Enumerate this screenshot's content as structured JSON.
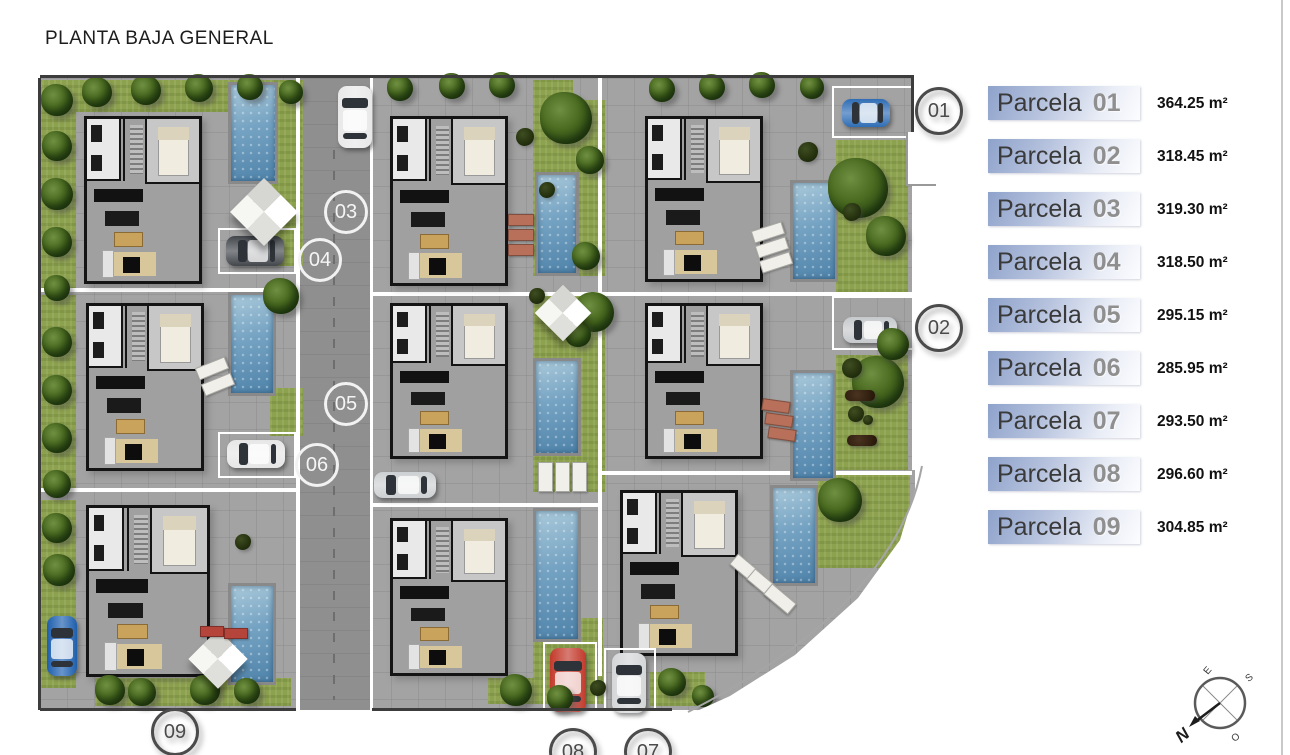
{
  "title": "PLANTA BAJA GENERAL",
  "legend": {
    "items": [
      {
        "label": "Parcela",
        "num": "01",
        "area": "364.25 m²"
      },
      {
        "label": "Parcela",
        "num": "02",
        "area": "318.45 m²"
      },
      {
        "label": "Parcela",
        "num": "03",
        "area": "319.30 m²"
      },
      {
        "label": "Parcela",
        "num": "04",
        "area": "318.50 m²"
      },
      {
        "label": "Parcela",
        "num": "05",
        "area": "295.15 m²"
      },
      {
        "label": "Parcela",
        "num": "06",
        "area": "285.95 m²"
      },
      {
        "label": "Parcela",
        "num": "07",
        "area": "293.50 m²"
      },
      {
        "label": "Parcela",
        "num": "08",
        "area": "296.60 m²"
      },
      {
        "label": "Parcela",
        "num": "09",
        "area": "304.85 m²"
      }
    ],
    "bar_x": 988,
    "bar_y_start": 86,
    "bar_step": 53,
    "area_x": 1157
  },
  "compass": {
    "n": "N",
    "e": "E",
    "s": "S",
    "o": "O"
  },
  "colors": {
    "pavement": "#a3a3a3",
    "road": "#8f8f8f",
    "lawn": "#8da24e",
    "pool_light": "#a9c9da",
    "pool_dark": "#4f83aa",
    "legend_blue": "#8ea2cb",
    "wall": "#141414"
  },
  "plan": {
    "base": [
      40,
      78,
      875,
      632
    ],
    "road": [
      300,
      78,
      72,
      632
    ],
    "road_dash": [
      333,
      150,
      550
    ],
    "lawns": [
      [
        40,
        80,
        36,
        210
      ],
      [
        42,
        80,
        258,
        32
      ],
      [
        272,
        80,
        31,
        186
      ],
      [
        533,
        80,
        40,
        34
      ],
      [
        533,
        100,
        72,
        176
      ],
      [
        836,
        140,
        72,
        152
      ],
      [
        40,
        295,
        36,
        194
      ],
      [
        270,
        388,
        33,
        48
      ],
      [
        533,
        292,
        72,
        200
      ],
      [
        836,
        355,
        72,
        115
      ],
      [
        40,
        500,
        36,
        188
      ],
      [
        95,
        678,
        196,
        28
      ],
      [
        533,
        618,
        70,
        86
      ],
      [
        488,
        678,
        46,
        26
      ],
      [
        818,
        473,
        92,
        95
      ],
      [
        650,
        672,
        55,
        34
      ]
    ],
    "pools": [
      [
        228,
        82,
        44,
        96
      ],
      [
        535,
        172,
        38,
        98
      ],
      [
        790,
        180,
        42,
        96
      ],
      [
        228,
        292,
        42,
        98
      ],
      [
        533,
        358,
        42,
        92
      ],
      [
        790,
        370,
        40,
        105
      ],
      [
        228,
        583,
        42,
        96
      ],
      [
        533,
        508,
        42,
        128
      ],
      [
        770,
        485,
        42,
        95
      ]
    ],
    "houses": [
      [
        84,
        116,
        112,
        162
      ],
      [
        390,
        116,
        112,
        164
      ],
      [
        645,
        116,
        112,
        160
      ],
      [
        86,
        303,
        112,
        162
      ],
      [
        390,
        303,
        112,
        150
      ],
      [
        645,
        303,
        112,
        150
      ],
      [
        86,
        505,
        118,
        166
      ],
      [
        390,
        518,
        112,
        152
      ],
      [
        620,
        490,
        112,
        160
      ]
    ],
    "trees": [
      [
        57,
        100,
        16
      ],
      [
        57,
        146,
        15
      ],
      [
        57,
        194,
        16
      ],
      [
        57,
        242,
        15
      ],
      [
        57,
        288,
        13
      ],
      [
        97,
        92,
        15
      ],
      [
        146,
        90,
        15
      ],
      [
        199,
        88,
        14
      ],
      [
        250,
        87,
        13
      ],
      [
        291,
        92,
        12
      ],
      [
        400,
        88,
        13
      ],
      [
        452,
        86,
        13
      ],
      [
        502,
        85,
        13
      ],
      [
        566,
        118,
        26
      ],
      [
        590,
        160,
        14
      ],
      [
        586,
        256,
        14
      ],
      [
        662,
        89,
        13
      ],
      [
        712,
        87,
        13
      ],
      [
        762,
        85,
        13
      ],
      [
        812,
        87,
        12
      ],
      [
        858,
        188,
        30
      ],
      [
        886,
        236,
        20
      ],
      [
        57,
        342,
        15
      ],
      [
        57,
        390,
        15
      ],
      [
        57,
        438,
        15
      ],
      [
        57,
        484,
        14
      ],
      [
        281,
        296,
        18
      ],
      [
        594,
        312,
        20
      ],
      [
        578,
        334,
        13
      ],
      [
        878,
        382,
        26
      ],
      [
        893,
        344,
        16
      ],
      [
        57,
        528,
        15
      ],
      [
        59,
        570,
        16
      ],
      [
        110,
        690,
        15
      ],
      [
        142,
        692,
        14
      ],
      [
        205,
        690,
        15
      ],
      [
        247,
        691,
        13
      ],
      [
        516,
        690,
        16
      ],
      [
        560,
        698,
        13
      ],
      [
        840,
        500,
        22
      ],
      [
        672,
        682,
        14
      ],
      [
        703,
        696,
        11
      ]
    ],
    "shrubs": [
      [
        525,
        137,
        9
      ],
      [
        547,
        190,
        8
      ],
      [
        537,
        296,
        8
      ],
      [
        808,
        152,
        10
      ],
      [
        852,
        212,
        9
      ],
      [
        852,
        368,
        10
      ],
      [
        243,
        542,
        8
      ],
      [
        598,
        688,
        8
      ],
      [
        856,
        414,
        8
      ],
      [
        868,
        420,
        5
      ]
    ],
    "umbrellas": [
      [
        240,
        188,
        48
      ],
      [
        543,
        293,
        40
      ],
      [
        197,
        638,
        42
      ]
    ],
    "lounger_groups": [
      {
        "x": 508,
        "y": 214,
        "w": 24,
        "h": 10,
        "n": 3,
        "dx": 0,
        "dy": 15,
        "rot": 0,
        "color": "#b8705a"
      },
      {
        "x": 752,
        "y": 226,
        "w": 30,
        "h": 11,
        "n": 3,
        "dx": 4,
        "dy": 15,
        "rot": -18,
        "color": "#f0efe9"
      },
      {
        "x": 196,
        "y": 362,
        "w": 30,
        "h": 11,
        "n": 2,
        "dx": 6,
        "dy": 16,
        "rot": -22,
        "color": "#f0efe9"
      },
      {
        "x": 762,
        "y": 400,
        "w": 26,
        "h": 10,
        "n": 3,
        "dx": 3,
        "dy": 14,
        "rot": 8,
        "color": "#b8705a"
      },
      {
        "x": 538,
        "y": 462,
        "w": 13,
        "h": 28,
        "n": 3,
        "dx": 17,
        "dy": 0,
        "rot": 0,
        "color": "#f0efe9"
      },
      {
        "x": 730,
        "y": 562,
        "w": 30,
        "h": 12,
        "n": 3,
        "dx": 17,
        "dy": 15,
        "rot": 40,
        "color": "#f0efe9"
      },
      {
        "x": 200,
        "y": 626,
        "w": 22,
        "h": 9,
        "n": 2,
        "dx": 24,
        "dy": 2,
        "rot": 0,
        "color": "#b5443a"
      }
    ],
    "benches": [
      [
        845,
        390,
        30,
        11
      ],
      [
        847,
        435,
        30,
        11
      ]
    ],
    "carports": [
      [
        218,
        228,
        74,
        42
      ],
      [
        218,
        432,
        74,
        42
      ],
      [
        832,
        86,
        78,
        48
      ],
      [
        832,
        296,
        78,
        50
      ],
      [
        543,
        642,
        50,
        70
      ],
      [
        604,
        648,
        48,
        66
      ]
    ],
    "cars": [
      {
        "x": 338,
        "y": 86,
        "w": 34,
        "h": 62,
        "color": "#e8e8e8"
      },
      {
        "x": 226,
        "y": 236,
        "w": 58,
        "h": 30,
        "color": "#43474c"
      },
      {
        "x": 842,
        "y": 99,
        "w": 48,
        "h": 28,
        "color": "#2f6db5"
      },
      {
        "x": 843,
        "y": 317,
        "w": 54,
        "h": 26,
        "color": "#c6c9cc"
      },
      {
        "x": 227,
        "y": 440,
        "w": 58,
        "h": 28,
        "color": "#e6e6e6"
      },
      {
        "x": 374,
        "y": 472,
        "w": 62,
        "h": 26,
        "color": "#cdd0d2"
      },
      {
        "x": 47,
        "y": 616,
        "w": 30,
        "h": 60,
        "color": "#1e5fae"
      },
      {
        "x": 550,
        "y": 648,
        "w": 36,
        "h": 64,
        "color": "#c2392b"
      },
      {
        "x": 612,
        "y": 653,
        "w": 34,
        "h": 60,
        "color": "#d4d6d8"
      }
    ],
    "white_lines": [
      [
        296,
        78,
        4,
        632
      ],
      [
        370,
        78,
        3,
        632
      ],
      [
        598,
        78,
        4,
        598
      ],
      [
        912,
        78,
        3,
        392
      ],
      [
        40,
        288,
        258,
        4
      ],
      [
        372,
        292,
        226,
        4
      ],
      [
        601,
        292,
        311,
        4
      ],
      [
        40,
        488,
        258,
        4
      ],
      [
        372,
        503,
        226,
        4
      ],
      [
        601,
        471,
        311,
        4
      ]
    ],
    "dark_lines": [
      [
        40,
        75,
        874,
        3
      ],
      [
        38,
        78,
        3,
        632
      ],
      [
        911,
        75,
        3,
        62
      ],
      [
        40,
        708,
        256,
        3
      ],
      [
        372,
        708,
        300,
        3
      ]
    ],
    "white_notch": [
      906,
      132,
      28,
      52
    ],
    "cut_polygon": "922,466 900,540 858,598 795,655 730,696 688,715 940,715 940,466",
    "cut_edge": "M922,466 C905,555 830,640 688,712",
    "markers_light": [
      {
        "num": "03",
        "x": 343,
        "y": 209
      },
      {
        "num": "04",
        "x": 317,
        "y": 257
      },
      {
        "num": "05",
        "x": 343,
        "y": 401
      },
      {
        "num": "06",
        "x": 314,
        "y": 462
      }
    ],
    "markers_dark": [
      {
        "num": "01",
        "x": 936,
        "y": 108
      },
      {
        "num": "02",
        "x": 936,
        "y": 325
      },
      {
        "num": "09",
        "x": 172,
        "y": 729
      },
      {
        "num": "08",
        "x": 570,
        "y": 749
      },
      {
        "num": "07",
        "x": 645,
        "y": 749
      }
    ]
  }
}
